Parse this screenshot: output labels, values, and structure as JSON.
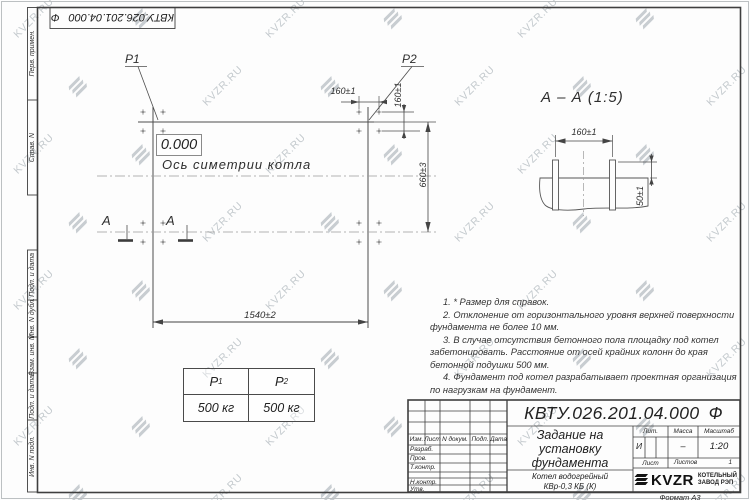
{
  "watermark": {
    "text": "KVZR.RU"
  },
  "stamp": {
    "doc_number": "КВТУ.026.201.04.000",
    "suffix": "Ф"
  },
  "sidebar": {
    "labels": [
      "Перв. примен.",
      "Справ. N",
      "Подп. и дата",
      "Инв. N дубл.",
      "Взам. инв. N",
      "Подп. и дата",
      "Инв. N подл."
    ]
  },
  "plan": {
    "p1": "P1",
    "p2": "P2",
    "level": "0.000",
    "axis": "Ось симетрии котла",
    "dim_bolt_h": "160±1",
    "dim_bolt_v": "160±1",
    "dim_width": "660±3",
    "dim_length": "1540±2",
    "section_letter_1": "А",
    "section_letter_2": "А"
  },
  "section": {
    "title": "А – А (1:5)",
    "dim_spacing": "160±1",
    "dim_height": "50±1"
  },
  "loads": {
    "headers": [
      {
        "name": "P",
        "sub": "1"
      },
      {
        "name": "P",
        "sub": "2"
      }
    ],
    "values": [
      "500 кг",
      "500 кг"
    ]
  },
  "notes": {
    "items": [
      "1. * Размер для справок.",
      "2. Отклонение от горизонтального уровня верхней поверхности фундамента не более 10 мм.",
      "3. В случае отсутствия бетонного пола площадку под котел забетонировать. Расстояние от осей крайних колонн до края бетонной подушки 500 мм.",
      "4. Фундамент под котел разрабатывает проектная организация по нагрузкам на фундамент."
    ]
  },
  "title_block": {
    "rev_headers": [
      "Изм.",
      "Лист",
      "N докум.",
      "Подп.",
      "Дата"
    ],
    "roles": [
      "Разраб.",
      "Пров.",
      "Т.контр.",
      "Н.контр.",
      "Утв."
    ],
    "doc_number": "КВТУ.026.201.04.000",
    "suffix": "Ф",
    "title_lines": [
      "Задание на",
      "установку",
      "фундамента"
    ],
    "product_lines": [
      "Котел водогрейный",
      "КВр-0,3 КБ (К)"
    ],
    "lit_label": "Лит.",
    "mass_label": "Масса",
    "scale_label": "Масштаб",
    "lit_value": "И",
    "mass_value": "–",
    "scale_value": "1:20",
    "sheet_label": "Лист",
    "sheets_label": "Листов",
    "sheets_value": "1",
    "logo_text": "KVZR",
    "logo_caption": [
      "КОТЕЛЬНЫЙ",
      "ЗАВОД РЭП"
    ],
    "format_label": "Формат А3"
  }
}
